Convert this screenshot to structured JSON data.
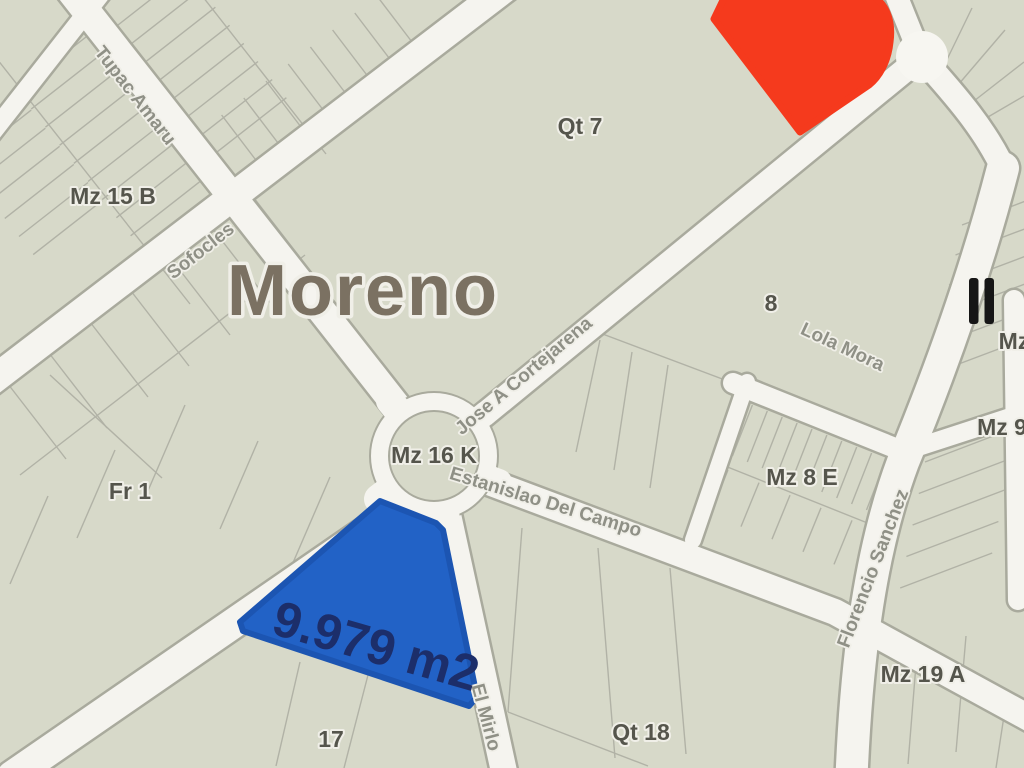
{
  "city": {
    "name": "Moreno"
  },
  "parcel_highlight": {
    "area_label": "9.979 m2",
    "fill": "#2262c6",
    "stroke": "#1c55b2",
    "text_color": "#1c2e6a"
  },
  "red_highlight": {
    "fill": "#f53a1d"
  },
  "blocks": {
    "mz15b": "Mz 15 B",
    "qt7": "Qt 7",
    "mz16k": "Mz 16 K",
    "fr1": "Fr 1",
    "block8": "8",
    "mz8e": "Mz 8 E",
    "mz9": "Mz 9",
    "mz_partial": "Mz",
    "mz19a": "Mz 19 A",
    "qt18": "Qt 18",
    "block17": "17"
  },
  "streets": {
    "tupac_amaru": "Tupac Amaru",
    "sofocles": "Sofocles",
    "jose_a_cortejarena": "Jose A Cortejarena",
    "estanislao_del_campo": "Estanislao Del Campo",
    "lola_mora": "Lola Mora",
    "florencio_sanchez": "Florencio Sanchez",
    "el_mirlo": "El Mirlo"
  },
  "icons": {
    "poi_bars": "parallel-bars"
  },
  "colors": {
    "block_fill": "#d7d9c9",
    "street_fill": "#f5f4ef",
    "street_casing": "#a9aa9d",
    "parcel_line": "#b1b2a6",
    "block_label": "#55554c",
    "street_label": "#8f9086",
    "city_label": "#7b7162",
    "label_halo": "#f0efe8",
    "poi_icon": "#161616"
  }
}
